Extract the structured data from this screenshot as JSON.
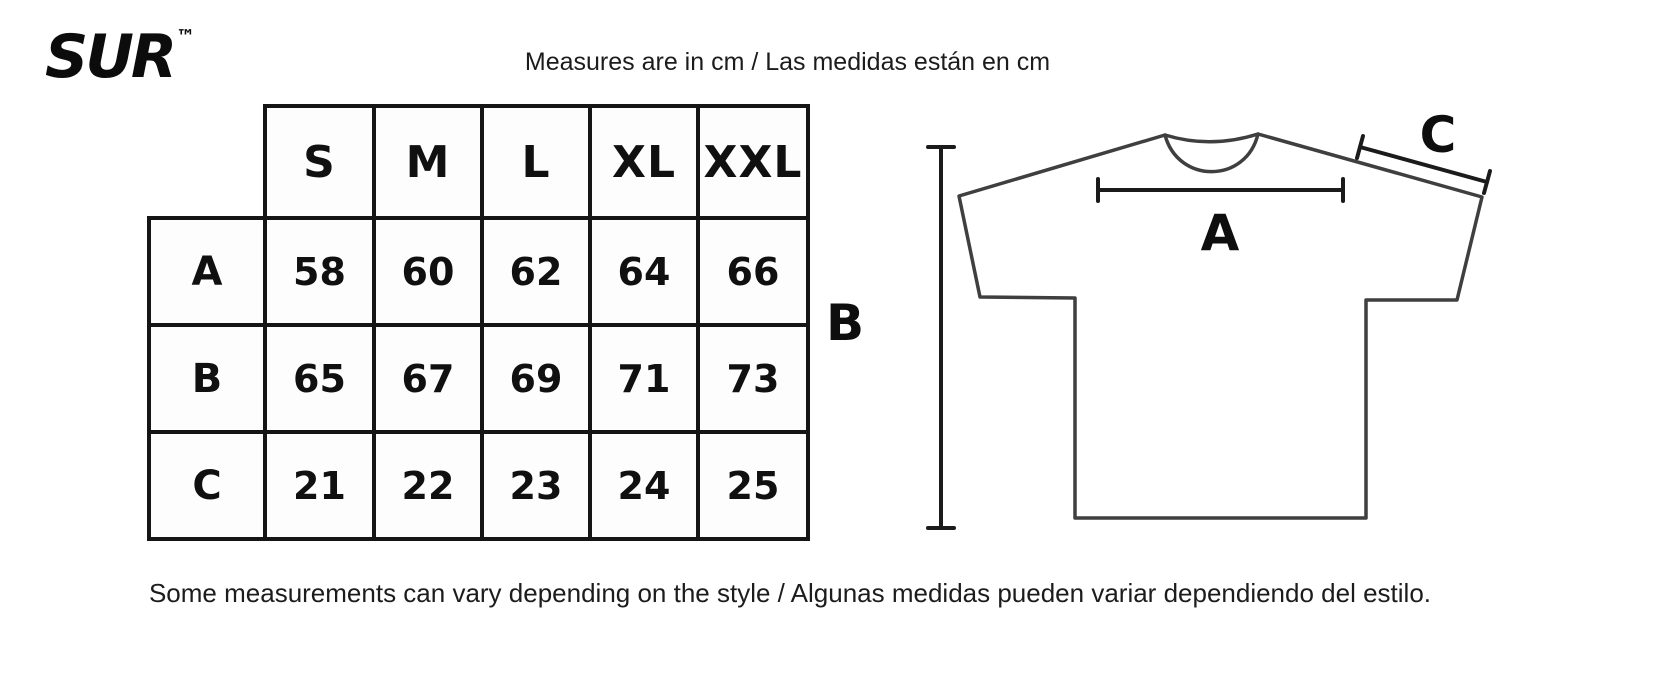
{
  "brand": {
    "logo_text": "SUR",
    "trademark": "™"
  },
  "header": {
    "title": "Measures are in cm / Las medidas están en cm"
  },
  "size_chart": {
    "columns": [
      "S",
      "M",
      "L",
      "XL",
      "XXL"
    ],
    "rows": [
      {
        "label": "A",
        "values": [
          58,
          60,
          62,
          64,
          66
        ]
      },
      {
        "label": "B",
        "values": [
          65,
          67,
          69,
          71,
          73
        ]
      },
      {
        "label": "C",
        "values": [
          21,
          22,
          23,
          24,
          25
        ]
      }
    ]
  },
  "chart_data": {
    "type": "table",
    "title": "Measures are in cm / Las medidas están en cm",
    "categories": [
      "S",
      "M",
      "L",
      "XL",
      "XXL"
    ],
    "series": [
      {
        "name": "A",
        "values": [
          58,
          60,
          62,
          64,
          66
        ]
      },
      {
        "name": "B",
        "values": [
          65,
          67,
          69,
          71,
          73
        ]
      },
      {
        "name": "C",
        "values": [
          21,
          22,
          23,
          24,
          25
        ]
      }
    ]
  },
  "diagram": {
    "chest_label": "A",
    "length_label": "B",
    "sleeve_label": "C"
  },
  "footer": {
    "note": "Some measurements can vary depending on the style / Algunas medidas pueden variar dependiendo del estilo."
  },
  "colors": {
    "background": "#ffffff",
    "text": "#141414",
    "table_border": "#151515",
    "shirt_outline": "#3f3f3f"
  }
}
